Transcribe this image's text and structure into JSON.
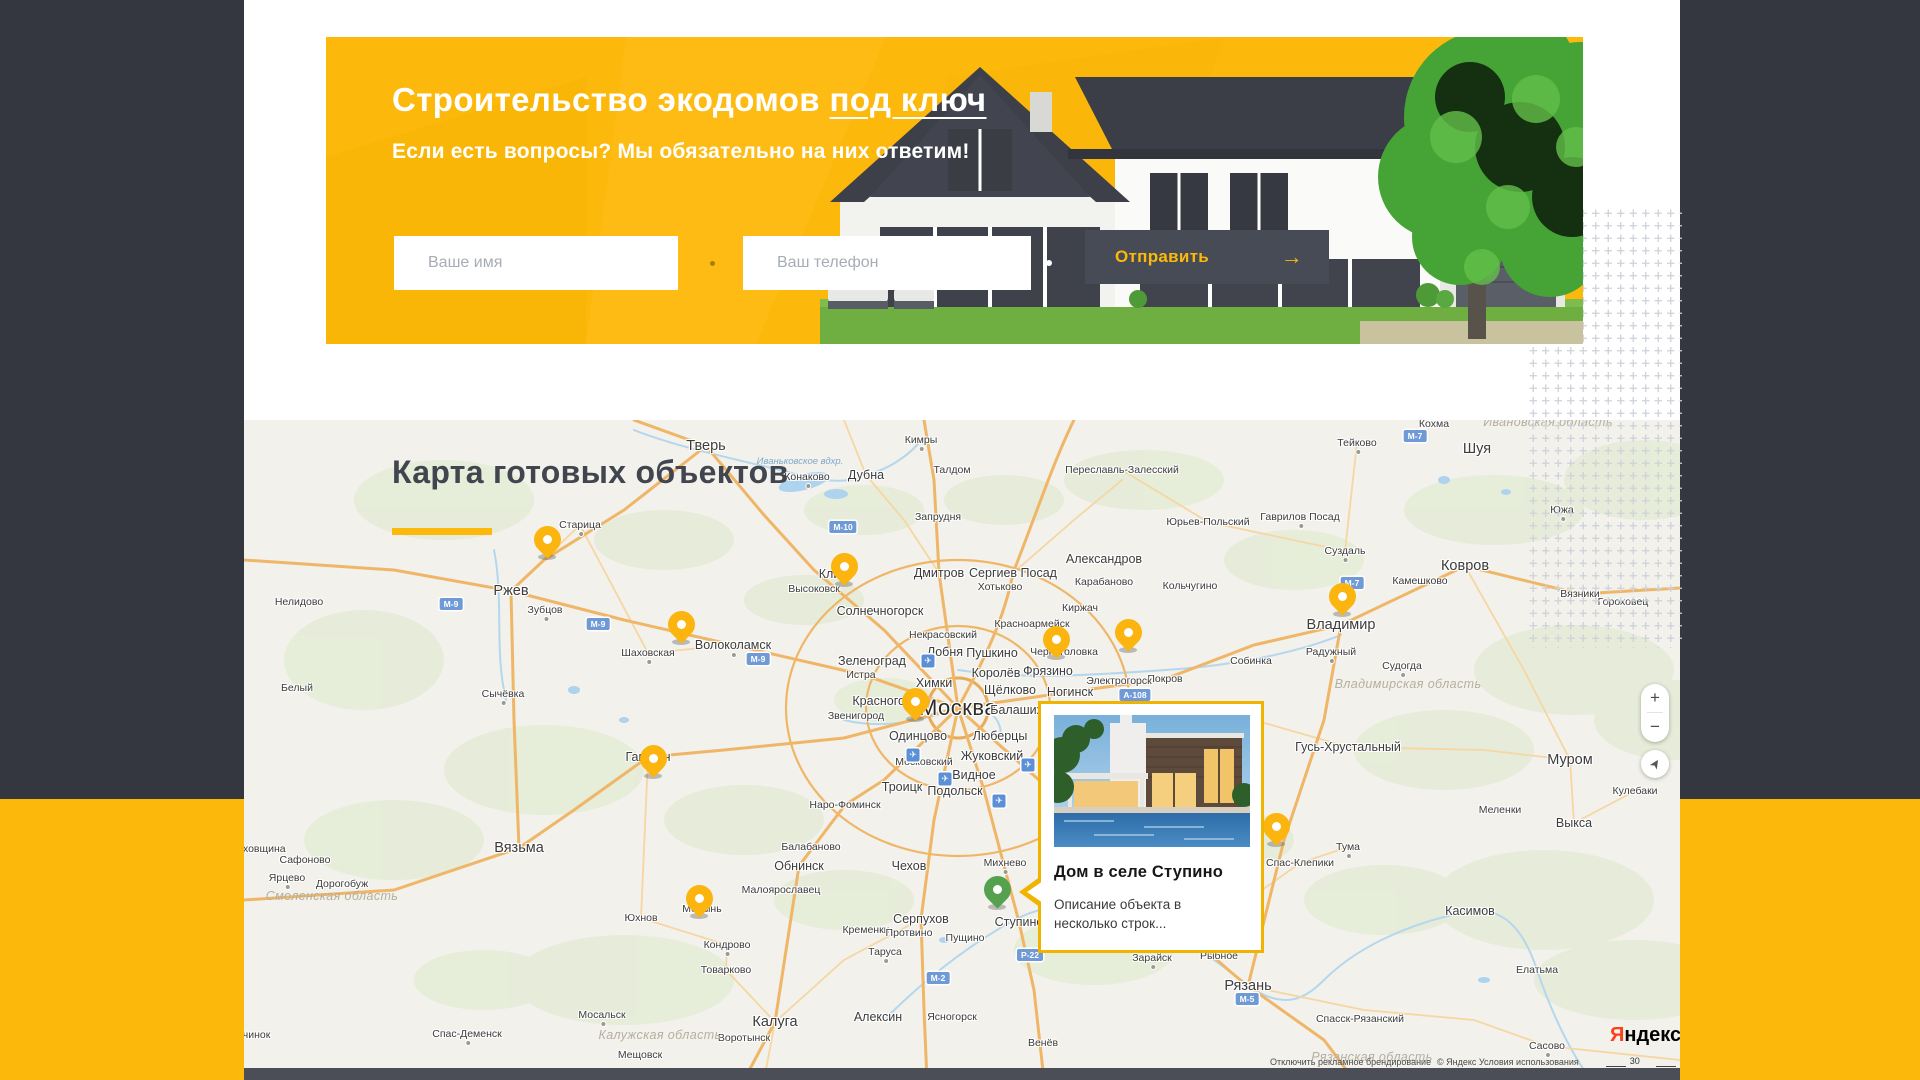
{
  "banner": {
    "title_plain": "Строительство экодомов ",
    "title_underlined": "под ключ",
    "subtitle": "Если есть вопросы? Мы обязательно на них ответим!",
    "form": {
      "name_placeholder": "Ваше имя",
      "phone_placeholder": "Ваш телефон",
      "submit_label": "Отправить",
      "submit_arrow": "→"
    },
    "accent_color": "#fcb90c",
    "button_color": "#474b56"
  },
  "map_section": {
    "title": "Карта готовых объектов",
    "popup": {
      "title": "Дом в селе Ступино",
      "description": "Описание объекта в несколько строк...",
      "border_color": "#f0b400"
    },
    "controls": {
      "zoom_in": "+",
      "zoom_out": "−",
      "geolocation": "➤"
    },
    "attribution": {
      "brand_first_letter": "Я",
      "brand_rest": "ндекс",
      "branding_link": "Отключить рекламное брендирование",
      "terms_link": "© Яндекс Условия использования",
      "scale_label": "30 км"
    },
    "pin_color": "#fcb40e",
    "selected_pin_color": "#55a14e",
    "pins": [
      {
        "x": 303,
        "y": 138,
        "place": "Старица"
      },
      {
        "x": 600,
        "y": 165,
        "place": "Клин"
      },
      {
        "x": 437,
        "y": 223,
        "place": "Волоколамск"
      },
      {
        "x": 812,
        "y": 238,
        "place": "Черноголовка"
      },
      {
        "x": 884,
        "y": 231,
        "place": "Киржач"
      },
      {
        "x": 1098,
        "y": 195,
        "place": "Владимир"
      },
      {
        "x": 671,
        "y": 300,
        "place": "Красногорск"
      },
      {
        "x": 409,
        "y": 357,
        "place": "Гагарин"
      },
      {
        "x": 1032,
        "y": 425,
        "place": "Спас-Клепики"
      },
      {
        "x": 455,
        "y": 497,
        "place": "Кондрово"
      },
      {
        "x": 753,
        "y": 488,
        "place": "Ступино",
        "selected": true
      }
    ],
    "labels": [
      {
        "t": "Тверь",
        "x": 462,
        "y": 26,
        "s": "lg"
      },
      {
        "t": "Конаково",
        "x": 563,
        "y": 57,
        "s": "sm",
        "d": true
      },
      {
        "t": "Дубна",
        "x": 622,
        "y": 55,
        "s": "md"
      },
      {
        "t": "Кимры",
        "x": 677,
        "y": 20,
        "s": "sm",
        "d": true
      },
      {
        "t": "Талдом",
        "x": 708,
        "y": 50,
        "s": "sm"
      },
      {
        "t": "Запрудня",
        "x": 694,
        "y": 97,
        "s": "sm"
      },
      {
        "t": "Переславль-Залесский",
        "x": 878,
        "y": 50,
        "s": "sm"
      },
      {
        "t": "Старица",
        "x": 336,
        "y": 105,
        "s": "sm",
        "d": true
      },
      {
        "t": "Ржев",
        "x": 267,
        "y": 171,
        "s": "lg"
      },
      {
        "t": "Зубцов",
        "x": 301,
        "y": 190,
        "s": "sm",
        "d": true
      },
      {
        "t": "Нелидово",
        "x": 55,
        "y": 182,
        "s": "sm"
      },
      {
        "t": "Белый",
        "x": 53,
        "y": 268,
        "s": "sm"
      },
      {
        "t": "Сычёвка",
        "x": 259,
        "y": 274,
        "s": "sm",
        "d": true
      },
      {
        "t": "Шаховская",
        "x": 404,
        "y": 233,
        "s": "sm",
        "d": true
      },
      {
        "t": "Волоколамск",
        "x": 489,
        "y": 225,
        "s": "md",
        "d": true
      },
      {
        "t": "Высоковск",
        "x": 570,
        "y": 169,
        "s": "sm"
      },
      {
        "t": "Клин",
        "x": 589,
        "y": 154,
        "s": "md"
      },
      {
        "t": "Солнечногорск",
        "x": 636,
        "y": 191,
        "s": "md"
      },
      {
        "t": "Дмитров",
        "x": 695,
        "y": 153,
        "s": "md"
      },
      {
        "t": "Сергиев Посад",
        "x": 769,
        "y": 153,
        "s": "md"
      },
      {
        "t": "Хотьково",
        "x": 756,
        "y": 167,
        "s": "sm"
      },
      {
        "t": "Александров",
        "x": 860,
        "y": 139,
        "s": "md"
      },
      {
        "t": "Карабаново",
        "x": 860,
        "y": 162,
        "s": "sm"
      },
      {
        "t": "Киржач",
        "x": 836,
        "y": 188,
        "s": "sm"
      },
      {
        "t": "Кольчугино",
        "x": 946,
        "y": 166,
        "s": "sm"
      },
      {
        "t": "Юрьев-Польский",
        "x": 964,
        "y": 102,
        "s": "sm"
      },
      {
        "t": "Гаврилов Посад",
        "x": 1056,
        "y": 97,
        "s": "sm",
        "d": true
      },
      {
        "t": "Суздаль",
        "x": 1101,
        "y": 131,
        "s": "sm",
        "d": true
      },
      {
        "t": "Тейково",
        "x": 1113,
        "y": 23,
        "s": "sm",
        "d": true
      },
      {
        "t": "Кохма",
        "x": 1190,
        "y": 4,
        "s": "sm"
      },
      {
        "t": "Шуя",
        "x": 1233,
        "y": 29,
        "s": "lg"
      },
      {
        "t": "Южа",
        "x": 1318,
        "y": 90,
        "s": "sm",
        "d": true
      },
      {
        "t": "Камешково",
        "x": 1176,
        "y": 161,
        "s": "sm"
      },
      {
        "t": "Ковров",
        "x": 1221,
        "y": 146,
        "s": "lg"
      },
      {
        "t": "Вязники",
        "x": 1336,
        "y": 174,
        "s": "sm"
      },
      {
        "t": "Гороховец",
        "x": 1379,
        "y": 182,
        "s": "sm"
      },
      {
        "t": "Владимир",
        "x": 1097,
        "y": 205,
        "s": "lg"
      },
      {
        "t": "Радужный",
        "x": 1087,
        "y": 232,
        "s": "sm",
        "d": true
      },
      {
        "t": "Судогда",
        "x": 1158,
        "y": 246,
        "s": "sm",
        "d": true
      },
      {
        "t": "Собинка",
        "x": 1007,
        "y": 241,
        "s": "sm"
      },
      {
        "t": "Покров",
        "x": 921,
        "y": 259,
        "s": "sm"
      },
      {
        "t": "Электрогорск",
        "x": 875,
        "y": 261,
        "s": "sm"
      },
      {
        "t": "Ногинск",
        "x": 826,
        "y": 272,
        "s": "md"
      },
      {
        "t": "Черноголовка",
        "x": 820,
        "y": 232,
        "s": "sm"
      },
      {
        "t": "Красноармейск",
        "x": 788,
        "y": 204,
        "s": "sm"
      },
      {
        "t": "Некрасовский",
        "x": 699,
        "y": 215,
        "s": "sm"
      },
      {
        "t": "Лобня",
        "x": 701,
        "y": 232,
        "s": "md"
      },
      {
        "t": "Пушкино",
        "x": 748,
        "y": 233,
        "s": "md"
      },
      {
        "t": "Королёв",
        "x": 752,
        "y": 253,
        "s": "md"
      },
      {
        "t": "Фрязино",
        "x": 804,
        "y": 251,
        "s": "md"
      },
      {
        "t": "Щёлково",
        "x": 766,
        "y": 270,
        "s": "md"
      },
      {
        "t": "Зеленоград",
        "x": 628,
        "y": 241,
        "s": "md"
      },
      {
        "t": "Истра",
        "x": 617,
        "y": 255,
        "s": "sm"
      },
      {
        "t": "Химки",
        "x": 690,
        "y": 263,
        "s": "md"
      },
      {
        "t": "Красногорск",
        "x": 644,
        "y": 281,
        "s": "md"
      },
      {
        "t": "Звенигород",
        "x": 612,
        "y": 296,
        "s": "sm"
      },
      {
        "t": "Москва",
        "x": 714,
        "y": 288,
        "s": "xl"
      },
      {
        "t": "Балашиха",
        "x": 776,
        "y": 290,
        "s": "md"
      },
      {
        "t": "Одинцово",
        "x": 674,
        "y": 316,
        "s": "md"
      },
      {
        "t": "Люберцы",
        "x": 756,
        "y": 316,
        "s": "md"
      },
      {
        "t": "Московский",
        "x": 680,
        "y": 342,
        "s": "sm"
      },
      {
        "t": "Жуковский",
        "x": 748,
        "y": 336,
        "s": "md"
      },
      {
        "t": "Видное",
        "x": 730,
        "y": 355,
        "s": "md"
      },
      {
        "t": "Троицк",
        "x": 658,
        "y": 367,
        "s": "md"
      },
      {
        "t": "Подольск",
        "x": 711,
        "y": 371,
        "s": "md"
      },
      {
        "t": "Наро-Фоминск",
        "x": 601,
        "y": 385,
        "s": "sm"
      },
      {
        "t": "Гагарин",
        "x": 404,
        "y": 337,
        "s": "md",
        "d": true
      },
      {
        "t": "Вязьма",
        "x": 275,
        "y": 428,
        "s": "lg"
      },
      {
        "t": "Сафоново",
        "x": 61,
        "y": 440,
        "s": "sm"
      },
      {
        "t": "Ярцево",
        "x": 43,
        "y": 458,
        "s": "sm",
        "d": true
      },
      {
        "t": "Дорогобуж",
        "x": 98,
        "y": 464,
        "s": "sm"
      },
      {
        "t": "Духовщина",
        "x": 14,
        "y": 429,
        "s": "sm"
      },
      {
        "t": "Юхнов",
        "x": 397,
        "y": 498,
        "s": "sm"
      },
      {
        "t": "Медынь",
        "x": 458,
        "y": 489,
        "s": "sm"
      },
      {
        "t": "Кондрово",
        "x": 483,
        "y": 525,
        "s": "sm",
        "d": true
      },
      {
        "t": "Товарково",
        "x": 482,
        "y": 550,
        "s": "sm"
      },
      {
        "t": "Балабаново",
        "x": 567,
        "y": 427,
        "s": "sm"
      },
      {
        "t": "Обнинск",
        "x": 555,
        "y": 446,
        "s": "md"
      },
      {
        "t": "Малоярославец",
        "x": 537,
        "y": 470,
        "s": "sm"
      },
      {
        "t": "Чехов",
        "x": 665,
        "y": 446,
        "s": "md"
      },
      {
        "t": "Серпухов",
        "x": 677,
        "y": 499,
        "s": "md"
      },
      {
        "t": "Кременки",
        "x": 622,
        "y": 510,
        "s": "sm"
      },
      {
        "t": "Протвино",
        "x": 665,
        "y": 513,
        "s": "sm"
      },
      {
        "t": "Пущино",
        "x": 721,
        "y": 518,
        "s": "sm"
      },
      {
        "t": "Таруса",
        "x": 641,
        "y": 532,
        "s": "sm",
        "d": true
      },
      {
        "t": "Алексин",
        "x": 634,
        "y": 597,
        "s": "md"
      },
      {
        "t": "Ясногорск",
        "x": 708,
        "y": 597,
        "s": "sm"
      },
      {
        "t": "Калуга",
        "x": 531,
        "y": 602,
        "s": "lg"
      },
      {
        "t": "Воротынск",
        "x": 500,
        "y": 618,
        "s": "sm"
      },
      {
        "t": "Мосальск",
        "x": 358,
        "y": 595,
        "s": "sm",
        "d": true
      },
      {
        "t": "Мещовск",
        "x": 396,
        "y": 635,
        "s": "sm"
      },
      {
        "t": "Спас-Деменск",
        "x": 223,
        "y": 614,
        "s": "sm",
        "d": true
      },
      {
        "t": "Починок",
        "x": 6,
        "y": 615,
        "s": "sm"
      },
      {
        "t": "Михнево",
        "x": 761,
        "y": 443,
        "s": "sm",
        "d": true
      },
      {
        "t": "Ступино",
        "x": 775,
        "y": 502,
        "s": "md"
      },
      {
        "t": "Венёв",
        "x": 799,
        "y": 623,
        "s": "sm"
      },
      {
        "t": "Зарайск",
        "x": 908,
        "y": 538,
        "s": "sm",
        "d": true
      },
      {
        "t": "Рыбное",
        "x": 975,
        "y": 536,
        "s": "sm"
      },
      {
        "t": "Рязань",
        "x": 1004,
        "y": 566,
        "s": "lg"
      },
      {
        "t": "Спасск-Рязанский",
        "x": 1116,
        "y": 599,
        "s": "sm"
      },
      {
        "t": "Спас-Клепики",
        "x": 1056,
        "y": 443,
        "s": "sm"
      },
      {
        "t": "Тума",
        "x": 1104,
        "y": 427,
        "s": "sm",
        "d": true
      },
      {
        "t": "Касимов",
        "x": 1226,
        "y": 491,
        "s": "md"
      },
      {
        "t": "Елатьма",
        "x": 1293,
        "y": 550,
        "s": "sm"
      },
      {
        "t": "Сасово",
        "x": 1303,
        "y": 626,
        "s": "sm",
        "d": true
      },
      {
        "t": "Гусь-Хрустальный",
        "x": 1104,
        "y": 327,
        "s": "md"
      },
      {
        "t": "Меленки",
        "x": 1256,
        "y": 390,
        "s": "sm"
      },
      {
        "t": "Кулебаки",
        "x": 1391,
        "y": 371,
        "s": "sm"
      },
      {
        "t": "Выкса",
        "x": 1330,
        "y": 403,
        "s": "md"
      },
      {
        "t": "Муром",
        "x": 1326,
        "y": 340,
        "s": "lg"
      }
    ],
    "region_labels": [
      {
        "t": "Владимирская область",
        "x": 1164,
        "y": 264
      },
      {
        "t": "Ивановская область",
        "x": 1304,
        "y": 2
      },
      {
        "t": "Калужская область",
        "x": 416,
        "y": 615
      },
      {
        "t": "Смоленская область",
        "x": 88,
        "y": 476
      },
      {
        "t": "Рязанская область",
        "x": 1128,
        "y": 637
      }
    ],
    "water_labels": [
      {
        "t": "Иваньковское вдхр.",
        "x": 556,
        "y": 42
      }
    ],
    "road_badges": [
      {
        "t": "М-10",
        "x": 599,
        "y": 107
      },
      {
        "t": "М-9",
        "x": 207,
        "y": 184
      },
      {
        "t": "М-9",
        "x": 354,
        "y": 204
      },
      {
        "t": "М-9",
        "x": 514,
        "y": 239
      },
      {
        "t": "М-7",
        "x": 1171,
        "y": 16
      },
      {
        "t": "М-7",
        "x": 1108,
        "y": 163
      },
      {
        "t": "А-108",
        "x": 891,
        "y": 275
      },
      {
        "t": "М-5",
        "x": 1003,
        "y": 579
      },
      {
        "t": "Р-22",
        "x": 786,
        "y": 535
      },
      {
        "t": "М-2",
        "x": 694,
        "y": 558
      }
    ],
    "airports": [
      {
        "x": 684,
        "y": 241
      },
      {
        "x": 669,
        "y": 335
      },
      {
        "x": 784,
        "y": 345
      },
      {
        "x": 701,
        "y": 359
      },
      {
        "x": 755,
        "y": 381
      }
    ]
  }
}
